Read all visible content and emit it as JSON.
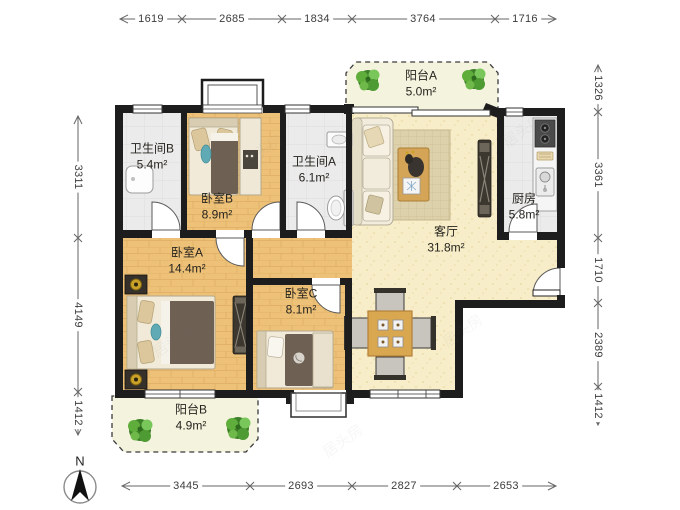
{
  "floorplan": {
    "rooms": {
      "balcony_a": {
        "name": "阳台A",
        "area": "5.0m²"
      },
      "bath_b": {
        "name": "卫生间B",
        "area": "5.4m²"
      },
      "bed_b": {
        "name": "卧室B",
        "area": "8.9m²"
      },
      "bath_a": {
        "name": "卫生间A",
        "area": "6.1m²"
      },
      "kitchen": {
        "name": "厨房",
        "area": "5.8m²"
      },
      "living": {
        "name": "客厅",
        "area": "31.8m²"
      },
      "bed_a": {
        "name": "卧室A",
        "area": "14.4m²"
      },
      "bed_c": {
        "name": "卧室C",
        "area": "8.1m²"
      },
      "balcony_b": {
        "name": "阳台B",
        "area": "4.9m²"
      }
    },
    "dimensions_mm": {
      "top": [
        "1619",
        "2685",
        "1834",
        "3764",
        "1716"
      ],
      "bottom": [
        "3445",
        "2693",
        "2827",
        "2653"
      ],
      "left": [
        "3311",
        "4149",
        "1412"
      ],
      "right": [
        "1326",
        "3361",
        "1710",
        "2389",
        "1412"
      ]
    },
    "compass": {
      "north_label": "N"
    },
    "watermark": {
      "text": "居头房"
    },
    "colors": {
      "wall": "#1d1d1d",
      "wood_floor": "#eec178",
      "living_floor": "#f7edc8",
      "tile_floor": "#ebebeb",
      "balcony_floor": "#f4f3de",
      "plant_green": "#4ea437"
    }
  }
}
